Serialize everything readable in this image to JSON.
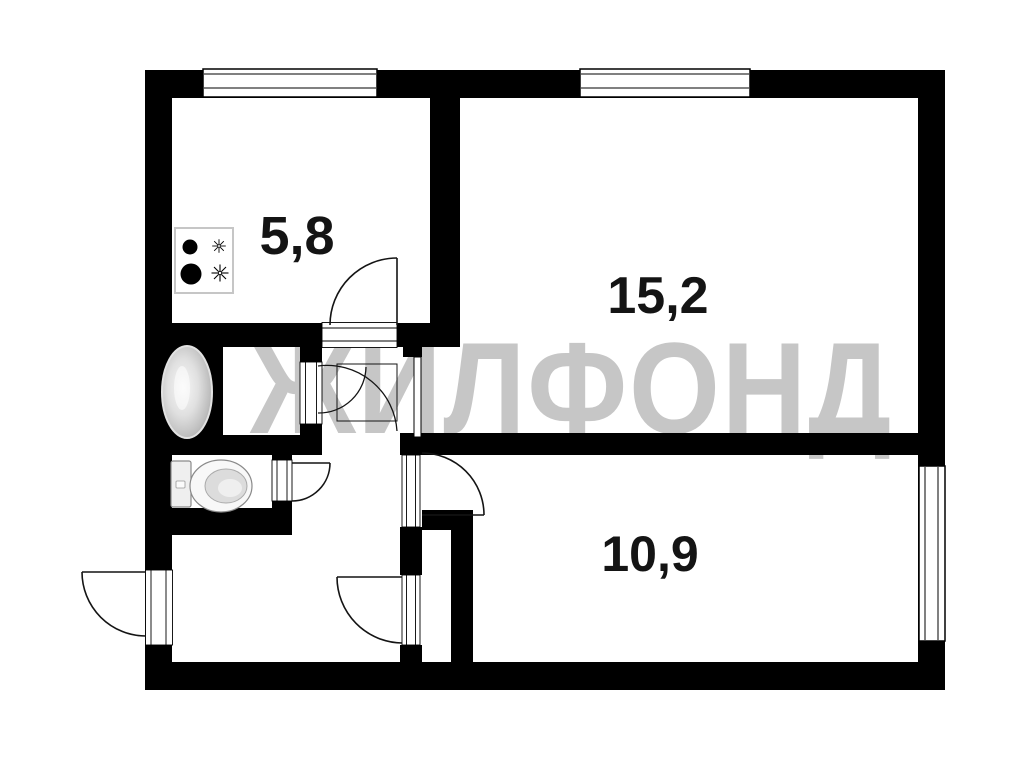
{
  "watermark": {
    "text": "ЖИЛФОНД",
    "color": "#c6c6c6"
  },
  "labels": {
    "color": "#141414"
  },
  "colors": {
    "wall": "#000000",
    "door_line": "#141414",
    "fixture_stroke": "#8a8a8a",
    "fixture_fill": "#f2f2f2",
    "stove_border": "#c6c6c6",
    "background": "#ffffff"
  },
  "plan": {
    "rooms": [
      {
        "id": "kitchen",
        "area": "5,8"
      },
      {
        "id": "living-room",
        "area": "15,2"
      },
      {
        "id": "bedroom",
        "area": "10,9"
      }
    ],
    "unlabeled_spaces": [
      "bathroom",
      "toilet",
      "hallway",
      "closet"
    ],
    "fixtures": [
      "stove",
      "bathtub",
      "toilet"
    ],
    "window_count": 3,
    "door_count": 6
  }
}
